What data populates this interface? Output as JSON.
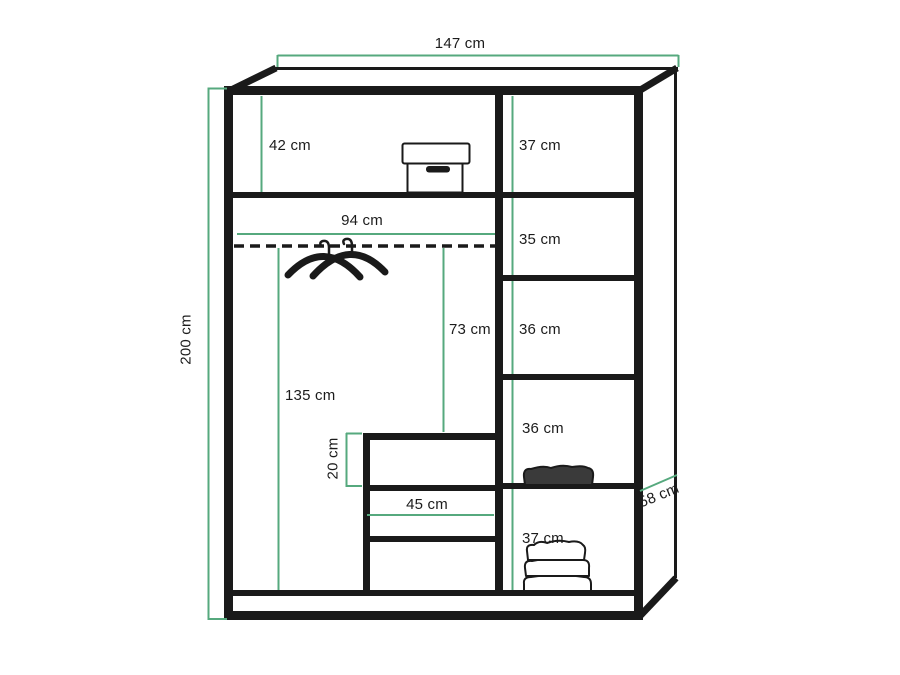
{
  "diagram": {
    "kind": "wardrobe-dimension-diagram",
    "background": "#ffffff",
    "outline_color": "#1a1a1a",
    "dimension_line_color": "#56a97e"
  },
  "dimensions": {
    "overall_width": "147 cm",
    "overall_height": "200 cm",
    "overall_depth": "58 cm",
    "left_top_shelf_height": "42 cm",
    "left_interior_width": "94 cm",
    "hanging_area_height": "135 cm",
    "rail_to_drawer_height": "73 cm",
    "top_drawer_height": "20 cm",
    "drawer_width": "45 cm",
    "right_shelf_heights": [
      "37 cm",
      "35 cm",
      "36 cm",
      "36 cm",
      "37 cm"
    ]
  },
  "illustrations": {
    "storage_box": "storage-box-icon",
    "hanging_rail": "hanging-rail-dashed-line",
    "coat_hangers": "coat-hangers-icon",
    "folded_garment": "folded-garment-icon",
    "folded_towels": "folded-towels-icon"
  }
}
